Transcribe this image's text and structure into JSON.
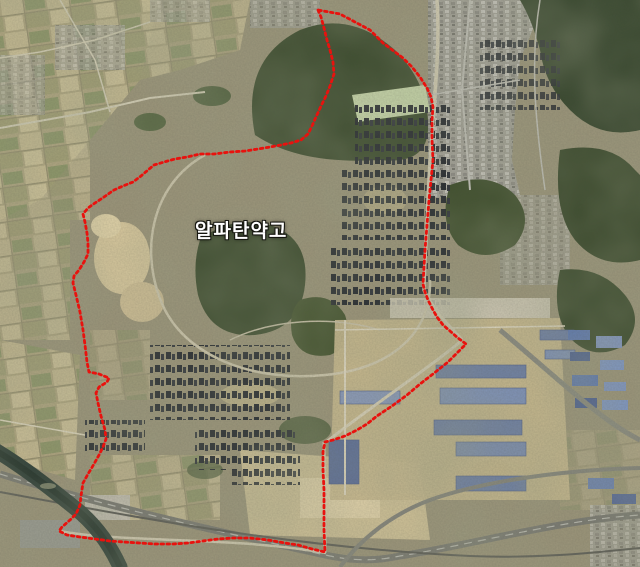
{
  "map": {
    "type": "satellite-imagery",
    "label": {
      "text": "알파탄약고",
      "x": 195,
      "y": 216,
      "font_size": 19,
      "color": "#ffffff",
      "halo_color": "#15150f"
    },
    "boundary": {
      "id": "alpha-depot-boundary",
      "color": "#e8120e",
      "stroke_width": 2.8,
      "dash": "2.6 3.4",
      "points": [
        [
          318,
          10
        ],
        [
          321,
          17
        ],
        [
          324,
          28
        ],
        [
          327,
          40
        ],
        [
          330,
          50
        ],
        [
          333,
          62
        ],
        [
          334,
          74
        ],
        [
          330,
          86
        ],
        [
          326,
          96
        ],
        [
          321,
          106
        ],
        [
          316,
          117
        ],
        [
          312,
          126
        ],
        [
          308,
          134
        ],
        [
          301,
          140
        ],
        [
          291,
          143
        ],
        [
          281,
          145
        ],
        [
          270,
          147
        ],
        [
          258,
          149
        ],
        [
          245,
          151
        ],
        [
          230,
          152
        ],
        [
          214,
          154
        ],
        [
          200,
          154
        ],
        [
          187,
          157
        ],
        [
          175,
          159
        ],
        [
          164,
          162
        ],
        [
          154,
          165
        ],
        [
          148,
          170
        ],
        [
          141,
          176
        ],
        [
          133,
          182
        ],
        [
          123,
          186
        ],
        [
          114,
          190
        ],
        [
          104,
          197
        ],
        [
          95,
          203
        ],
        [
          88,
          208
        ],
        [
          83,
          214
        ],
        [
          85,
          222
        ],
        [
          87,
          233
        ],
        [
          88,
          243
        ],
        [
          88,
          254
        ],
        [
          84,
          262
        ],
        [
          79,
          270
        ],
        [
          74,
          276
        ],
        [
          73,
          283
        ],
        [
          76,
          295
        ],
        [
          80,
          312
        ],
        [
          83,
          330
        ],
        [
          85,
          345
        ],
        [
          87,
          362
        ],
        [
          89,
          372
        ],
        [
          99,
          374
        ],
        [
          109,
          378
        ],
        [
          107,
          382
        ],
        [
          99,
          387
        ],
        [
          96,
          393
        ],
        [
          98,
          403
        ],
        [
          101,
          416
        ],
        [
          105,
          430
        ],
        [
          106,
          439
        ],
        [
          103,
          447
        ],
        [
          99,
          455
        ],
        [
          94,
          464
        ],
        [
          88,
          474
        ],
        [
          83,
          483
        ],
        [
          81,
          496
        ],
        [
          80,
          505
        ],
        [
          76,
          514
        ],
        [
          70,
          520
        ],
        [
          62,
          527
        ],
        [
          59,
          531
        ],
        [
          67,
          535
        ],
        [
          80,
          537
        ],
        [
          95,
          539
        ],
        [
          110,
          541
        ],
        [
          124,
          542
        ],
        [
          140,
          543
        ],
        [
          155,
          544
        ],
        [
          173,
          544
        ],
        [
          188,
          543
        ],
        [
          203,
          541
        ],
        [
          218,
          539
        ],
        [
          233,
          538
        ],
        [
          250,
          538
        ],
        [
          268,
          540
        ],
        [
          285,
          543
        ],
        [
          298,
          545
        ],
        [
          312,
          549
        ],
        [
          325,
          552
        ],
        [
          324,
          530
        ],
        [
          324,
          510
        ],
        [
          324,
          490
        ],
        [
          323,
          470
        ],
        [
          323,
          452
        ],
        [
          325,
          442
        ],
        [
          333,
          440
        ],
        [
          345,
          436
        ],
        [
          357,
          430
        ],
        [
          367,
          424
        ],
        [
          377,
          416
        ],
        [
          392,
          406
        ],
        [
          407,
          395
        ],
        [
          420,
          384
        ],
        [
          433,
          374
        ],
        [
          448,
          362
        ],
        [
          458,
          352
        ],
        [
          466,
          344
        ],
        [
          458,
          338
        ],
        [
          450,
          331
        ],
        [
          443,
          325
        ],
        [
          437,
          317
        ],
        [
          433,
          310
        ],
        [
          428,
          300
        ],
        [
          425,
          292
        ],
        [
          423,
          284
        ],
        [
          425,
          250
        ],
        [
          427,
          225
        ],
        [
          429,
          200
        ],
        [
          431,
          180
        ],
        [
          433,
          160
        ],
        [
          432,
          140
        ],
        [
          432,
          120
        ],
        [
          433,
          107
        ],
        [
          431,
          97
        ],
        [
          427,
          88
        ],
        [
          420,
          77
        ],
        [
          412,
          67
        ],
        [
          403,
          58
        ],
        [
          395,
          52
        ],
        [
          383,
          43
        ],
        [
          370,
          30
        ],
        [
          355,
          22
        ],
        [
          340,
          14
        ],
        [
          318,
          10
        ]
      ]
    }
  }
}
